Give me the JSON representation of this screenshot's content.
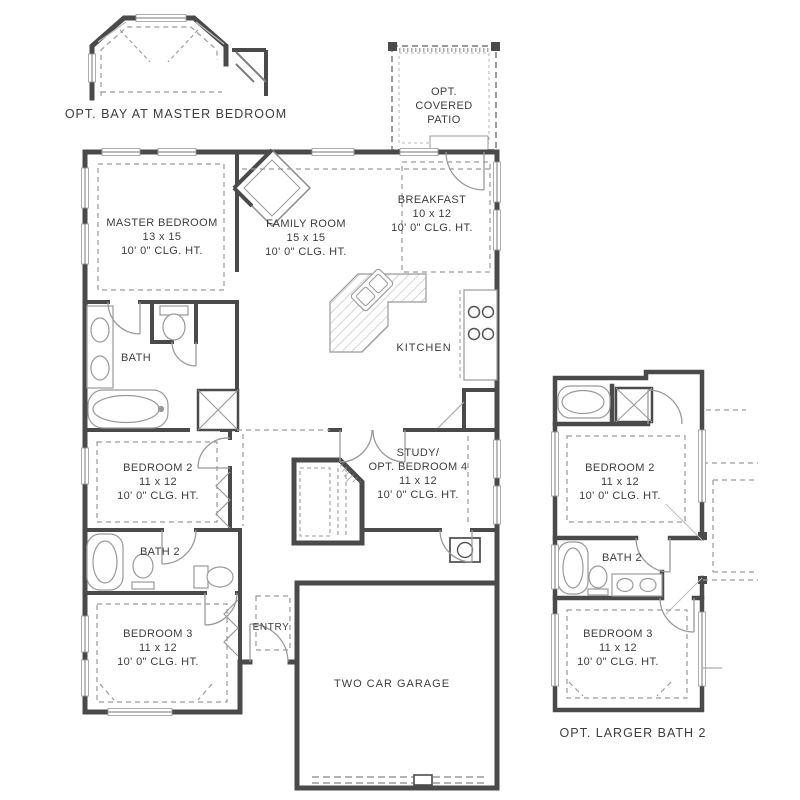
{
  "palette": {
    "wall": "#4a4a4a",
    "line": "#9a9a9a",
    "ink": "#3d3d3d",
    "background": "#ffffff"
  },
  "details": {
    "bay": {
      "caption": "OPT. BAY AT MASTER BEDROOM"
    },
    "patio": {
      "line1": "OPT.",
      "line2": "COVERED",
      "line3": "PATIO"
    },
    "larger_bath": {
      "caption": "OPT. LARGER BATH 2"
    }
  },
  "rooms": {
    "master_bedroom": {
      "name": "MASTER BEDROOM",
      "size": "13 x 15",
      "clg": "10' 0\" CLG. HT."
    },
    "family_room": {
      "name": "FAMILY ROOM",
      "size": "15 x 15",
      "clg": "10' 0\" CLG. HT."
    },
    "breakfast": {
      "name": "BREAKFAST",
      "size": "10 x 12",
      "clg": "10' 0\" CLG. HT."
    },
    "kitchen": {
      "name": "KITCHEN"
    },
    "bath": {
      "name": "BATH"
    },
    "bedroom2": {
      "name": "BEDROOM 2",
      "size": "11 x 12",
      "clg": "10' 0\" CLG. HT."
    },
    "study": {
      "name_line1": "STUDY/",
      "name_line2": "OPT. BEDROOM 4",
      "size": "11 x 12",
      "clg": "10' 0\" CLG. HT."
    },
    "bath2": {
      "name": "BATH 2"
    },
    "bedroom3": {
      "name": "BEDROOM 3",
      "size": "11 x 12",
      "clg": "10' 0\" CLG. HT."
    },
    "entry": {
      "name": "ENTRY"
    },
    "garage": {
      "name": "TWO CAR GARAGE"
    }
  },
  "inset": {
    "bedroom2": {
      "name": "BEDROOM 2",
      "size": "11 x 12",
      "clg": "10' 0\" CLG. HT."
    },
    "bath2": {
      "name": "BATH 2"
    },
    "bedroom3": {
      "name": "BEDROOM 3",
      "size": "11 x 12",
      "clg": "10' 0\" CLG. HT."
    }
  }
}
